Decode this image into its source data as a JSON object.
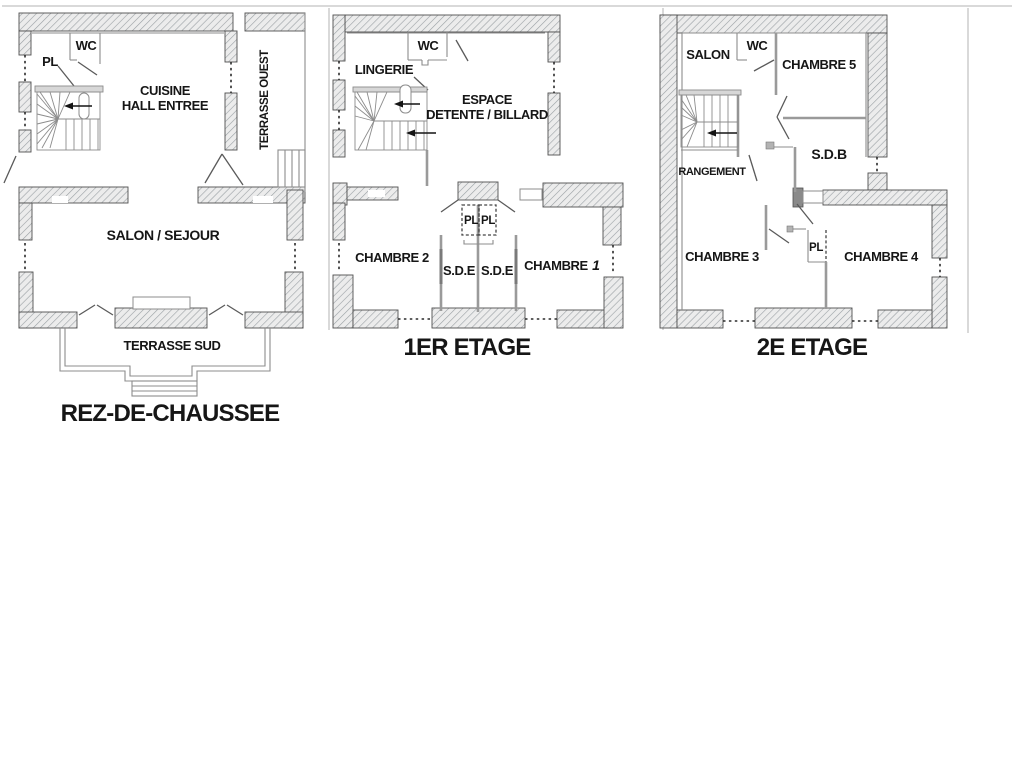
{
  "document": {
    "type": "architectural-floor-plans",
    "background": "#ffffff"
  },
  "colors": {
    "wall_fill": "#ececec",
    "hatch_line": "#9aa0a4",
    "wall_outline": "#4f4f4f",
    "text": "#161616",
    "chambre1_number": "#20259a"
  },
  "plans": {
    "rdc": {
      "title": "REZ-DE-CHAUSSEE",
      "labels": {
        "pl": "PL",
        "wc": "WC",
        "cuisine1": "CUISINE",
        "cuisine2": "HALL ENTREE",
        "terrasse_ouest": "TERRASSE OUEST",
        "salon_sejour": "SALON / SEJOUR",
        "terrasse_sud": "TERRASSE SUD"
      }
    },
    "etage1": {
      "title": "1ER ETAGE",
      "labels": {
        "lingerie": "LINGERIE",
        "wc": "WC",
        "espace1": "ESPACE",
        "espace2": "DETENTE / BILLARD",
        "pl_left": "PL",
        "pl_right": "PL",
        "chambre2": "CHAMBRE 2",
        "sde_left": "S.D.E",
        "sde_right": "S.D.E",
        "chambre1_word": "CHAMBRE",
        "chambre1_num": "1"
      }
    },
    "etage2": {
      "title": "2E ETAGE",
      "labels": {
        "salon": "SALON",
        "wc": "WC",
        "chambre5": "CHAMBRE 5",
        "sdb": "S.D.B",
        "rangement": "RANGEMENT",
        "chambre3": "CHAMBRE 3",
        "pl": "PL",
        "chambre4": "CHAMBRE 4"
      }
    }
  }
}
